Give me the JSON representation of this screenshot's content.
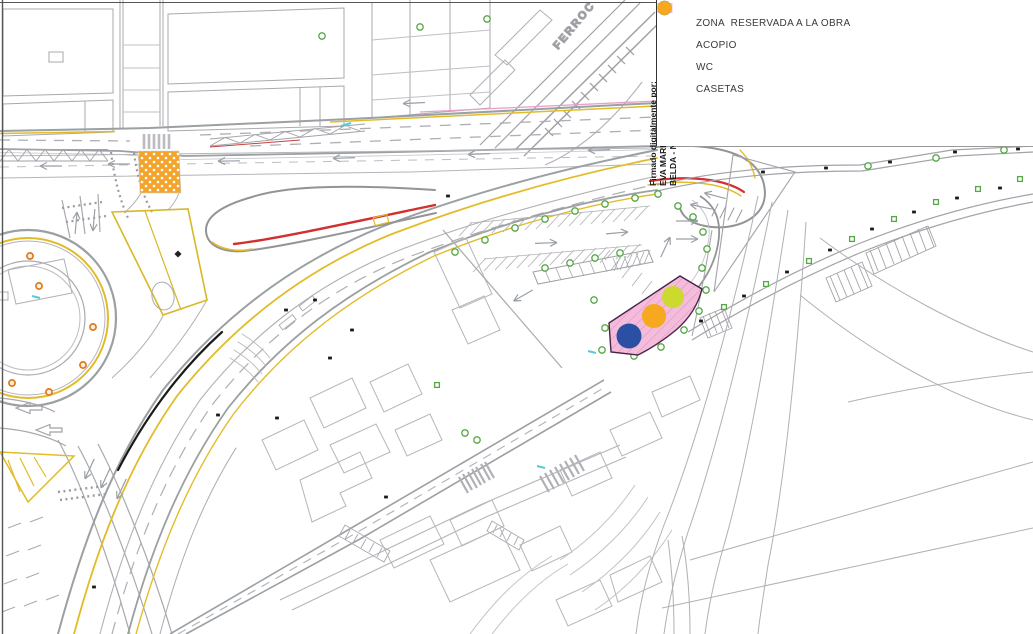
{
  "legend": {
    "items": [
      {
        "id": "zona-obra",
        "shape": "rect",
        "color": "#f3bcdb",
        "label": "ZONA  RESERVADA A LA OBRA"
      },
      {
        "id": "acopio",
        "shape": "circle",
        "color": "#2b4fa2",
        "label": "ACOPIO"
      },
      {
        "id": "wc",
        "shape": "circle",
        "color": "#ccd92f",
        "label": "WC"
      },
      {
        "id": "casetas",
        "shape": "circle",
        "color": "#f6a81f",
        "label": "CASETAS"
      }
    ]
  },
  "signature": {
    "line1": "Firmado digitalmente por:",
    "line2": "EVA MARIA HERNANDEZ",
    "line3": "BELDA - NIF:21652780M"
  },
  "map": {
    "railway_label": "FERROC",
    "colors": {
      "road_gray": "#9aa0a3",
      "building_gray": "#b6b6bc",
      "marking_yellow": "#e2bc28",
      "accent_red": "#d32f2f",
      "boundary_pink": "#e8a0c8",
      "tree_green": "#55a844",
      "crosswalk_orange": "#f2a42c"
    }
  }
}
